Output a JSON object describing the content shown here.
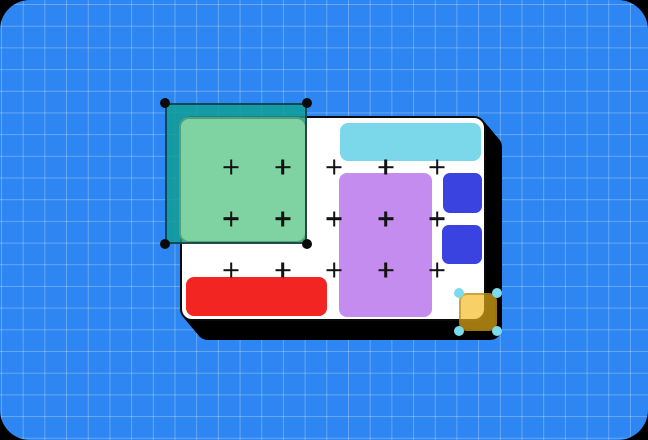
{
  "scene": {
    "description": "design-canvas illustration with marquee selection and shape handles",
    "background": {
      "outer_color": "#000000",
      "fill": "#2D86F1",
      "grid_color": "rgba(255,255,255,0.27)",
      "grid_size": 21.7,
      "grid_offset_x": 1,
      "grid_offset_y": 4,
      "corner_radius": 30
    },
    "artboard": {
      "x": 180,
      "y": 116,
      "w": 306,
      "h": 205,
      "radius": 12,
      "fill": "#FFFFFF",
      "border_width": 2,
      "border_color": "#0A0A0A",
      "shadow_color": "#000000",
      "shadow_offset_x": 16,
      "shadow_offset_y": 19
    },
    "shapes": {
      "cyan-bar": {
        "x": 340,
        "y": 123,
        "w": 141,
        "h": 38,
        "radius": 8,
        "fill": "#7BD8EA"
      },
      "purple-rect": {
        "x": 339,
        "y": 173,
        "w": 93,
        "h": 144,
        "radius": 8,
        "fill": "#C48CEE"
      },
      "blue-square-top": {
        "x": 443,
        "y": 173,
        "w": 39,
        "h": 40,
        "radius": 7,
        "fill": "#3A43E0"
      },
      "blue-square-bottom": {
        "x": 442,
        "y": 225,
        "w": 40,
        "h": 39,
        "radius": 7,
        "fill": "#3A43E0"
      },
      "red-bar": {
        "x": 186,
        "y": 277,
        "w": 141,
        "h": 39,
        "radius": 8,
        "fill": "#F32522"
      },
      "green-rect": {
        "x": 179,
        "y": 117,
        "w": 128,
        "h": 126,
        "radius": 10,
        "fill": "#7FD3A3",
        "border_width": 2,
        "border_color": "rgba(13,62,47,0.35)"
      }
    },
    "marquee_selection": {
      "x": 165,
      "y": 103,
      "w": 142,
      "h": 141,
      "fill": "rgba(16,158,150,0.85)",
      "border_width": 2,
      "border_color": "rgba(8,22,34,0.62)",
      "handle_color": "#0A0A0A",
      "handle_size": 10
    },
    "plus_markers": {
      "cols": [
        231,
        282.5,
        334,
        385.5,
        437
      ],
      "rows": [
        167,
        218.5,
        270
      ],
      "size": 15,
      "stroke": 2.6,
      "color": "#121212"
    },
    "yellow_selection": {
      "x": 459,
      "y": 293,
      "w": 38,
      "h": 38,
      "radius": 8,
      "fill": "rgba(244,184,26,0.66)",
      "border_width": 2,
      "border_color": "rgba(151,109,8,0.45)",
      "handle_color": "#7EDBED",
      "handle_size": 10
    }
  }
}
